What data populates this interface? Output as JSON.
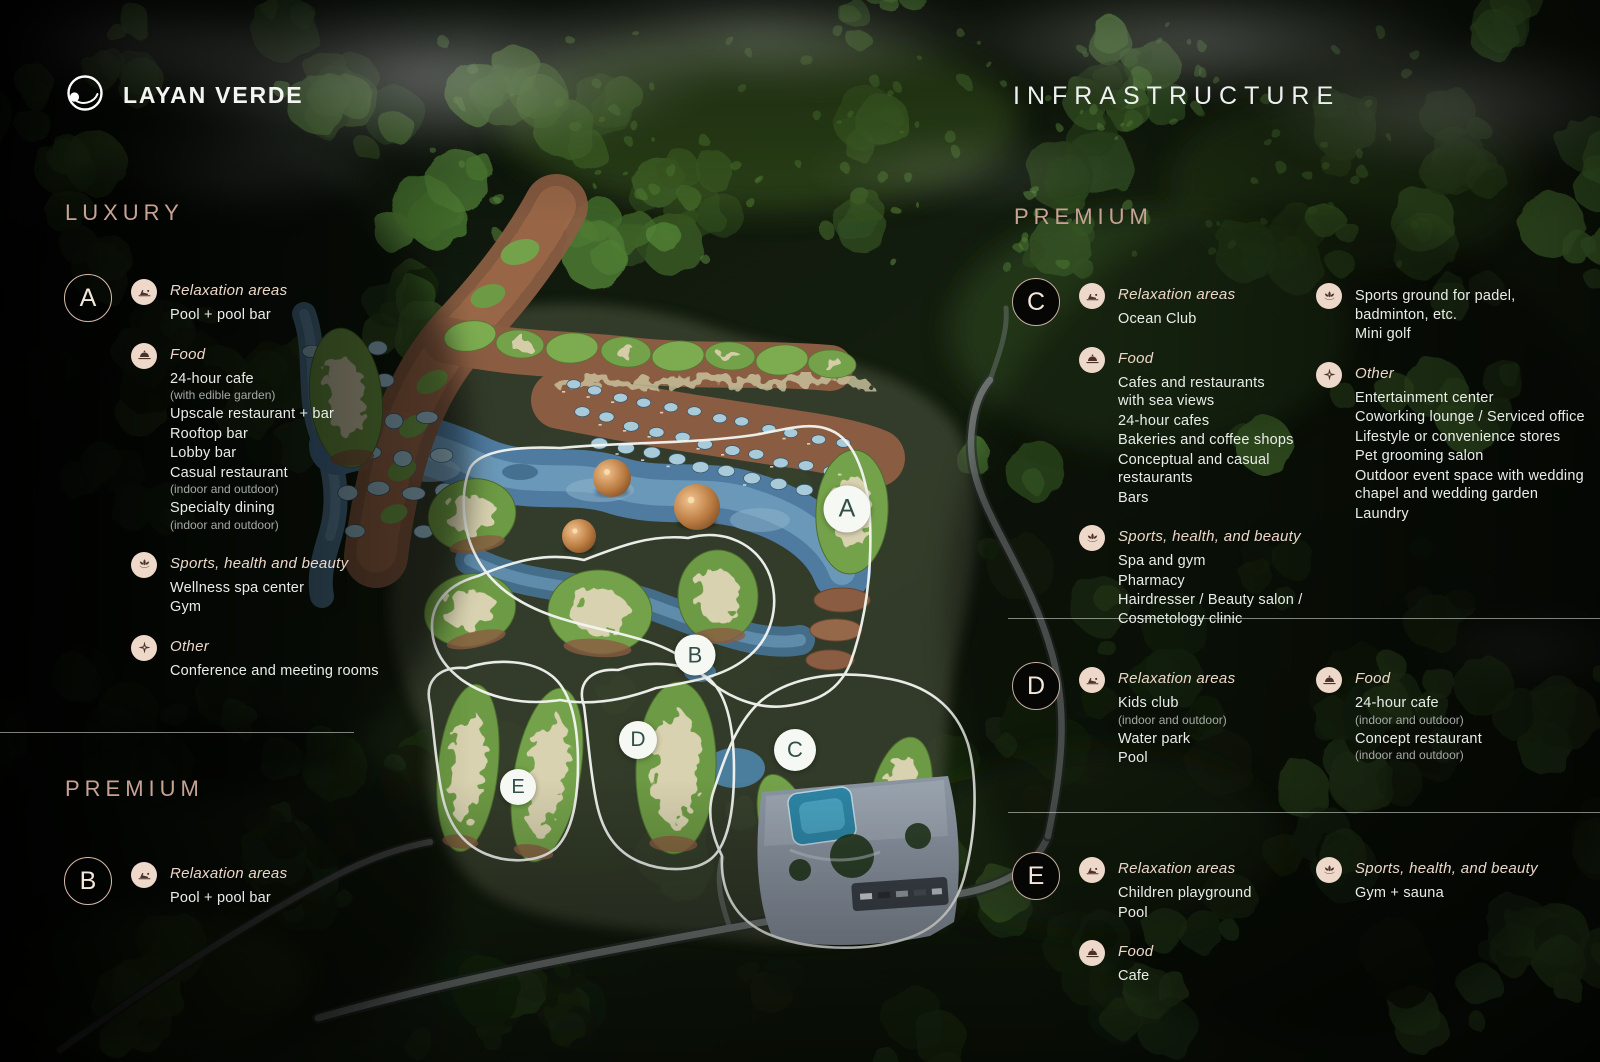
{
  "brand": {
    "name": "LAYAN VERDE",
    "logo_icon": "orbit-ring-icon"
  },
  "title": "INFRASTRUCTURE",
  "headings": {
    "luxury": "LUXURY",
    "premium_left": "PREMIUM",
    "premium_right": "PREMIUM"
  },
  "colors": {
    "accent_rose": "#c7a394",
    "icon_circle_bg": "#eed8ca",
    "badge_outline": "#d8bcab",
    "map_badge_letter": "#315047"
  },
  "zones": {
    "a": {
      "letter": "A",
      "groups": [
        {
          "icon": "lounger-icon",
          "label": "Relaxation areas",
          "items": [
            {
              "text": "Pool + pool bar"
            }
          ]
        },
        {
          "icon": "food-icon",
          "label": "Food",
          "items": [
            {
              "text": "24-hour cafe",
              "note": "(with edible garden)"
            },
            {
              "text": "Upscale restaurant + bar"
            },
            {
              "text": "Rooftop bar"
            },
            {
              "text": "Lobby bar"
            },
            {
              "text": "Casual restaurant",
              "note": "(indoor and outdoor)"
            },
            {
              "text": "Specialty dining",
              "note": "(indoor and outdoor)"
            }
          ]
        },
        {
          "icon": "lotus-icon",
          "label": "Sports, health and beauty",
          "items": [
            {
              "text": "Wellness spa center"
            },
            {
              "text": "Gym"
            }
          ]
        },
        {
          "icon": "compass-icon",
          "label": "Other",
          "items": [
            {
              "text": "Conference and meeting rooms"
            }
          ]
        }
      ]
    },
    "b": {
      "letter": "B",
      "groups": [
        {
          "icon": "lounger-icon",
          "label": "Relaxation areas",
          "items": [
            {
              "text": "Pool + pool bar"
            }
          ]
        }
      ]
    },
    "c": {
      "letter": "C",
      "col1": [
        {
          "icon": "lounger-icon",
          "label": "Relaxation areas",
          "items": [
            {
              "text": "Ocean Club"
            }
          ]
        },
        {
          "icon": "food-icon",
          "label": "Food",
          "items": [
            {
              "text": "Cafes and restaurants\nwith sea views"
            },
            {
              "text": "24-hour cafes"
            },
            {
              "text": "Bakeries and coffee shops"
            },
            {
              "text": "Conceptual and casual restaurants"
            },
            {
              "text": "Bars"
            }
          ]
        },
        {
          "icon": "lotus-icon",
          "label": "Sports, health, and beauty",
          "items": [
            {
              "text": "Spa and gym"
            },
            {
              "text": "Pharmacy"
            },
            {
              "text": "Hairdresser / Beauty salon /\nCosmetology clinic"
            }
          ]
        }
      ],
      "col2": [
        {
          "icon": "lotus-icon",
          "items": [
            {
              "text": "Sports ground for padel,\nbadminton, etc."
            },
            {
              "text": "Mini golf"
            }
          ]
        },
        {
          "icon": "compass-icon",
          "label": "Other",
          "items": [
            {
              "text": "Entertainment center"
            },
            {
              "text": "Coworking lounge / Serviced office"
            },
            {
              "text": "Lifestyle or convenience stores"
            },
            {
              "text": "Pet grooming salon"
            },
            {
              "text": "Outdoor event space with wedding\nchapel and wedding garden"
            },
            {
              "text": "Laundry"
            }
          ]
        }
      ]
    },
    "d": {
      "letter": "D",
      "col1": [
        {
          "icon": "lounger-icon",
          "label": "Relaxation areas",
          "items": [
            {
              "text": "Kids club",
              "note": "(indoor and outdoor)"
            },
            {
              "text": "Water park"
            },
            {
              "text": "Pool"
            }
          ]
        }
      ],
      "col2": [
        {
          "icon": "food-icon",
          "label": "Food",
          "items": [
            {
              "text": "24-hour cafe",
              "note": "(indoor and outdoor)"
            },
            {
              "text": "Concept restaurant",
              "note": "(indoor and outdoor)"
            }
          ]
        }
      ]
    },
    "e": {
      "letter": "E",
      "col1": [
        {
          "icon": "lounger-icon",
          "label": "Relaxation areas",
          "items": [
            {
              "text": "Children playground"
            },
            {
              "text": "Pool"
            }
          ]
        },
        {
          "icon": "food-icon",
          "label": "Food",
          "items": [
            {
              "text": "Cafe"
            }
          ]
        }
      ],
      "col2": [
        {
          "icon": "lotus-icon",
          "label": "Sports, health, and beauty",
          "items": [
            {
              "text": "Gym + sauna"
            }
          ]
        }
      ]
    }
  },
  "map": {
    "badges": [
      {
        "letter": "A"
      },
      {
        "letter": "B"
      },
      {
        "letter": "C"
      },
      {
        "letter": "D"
      },
      {
        "letter": "E"
      }
    ]
  }
}
